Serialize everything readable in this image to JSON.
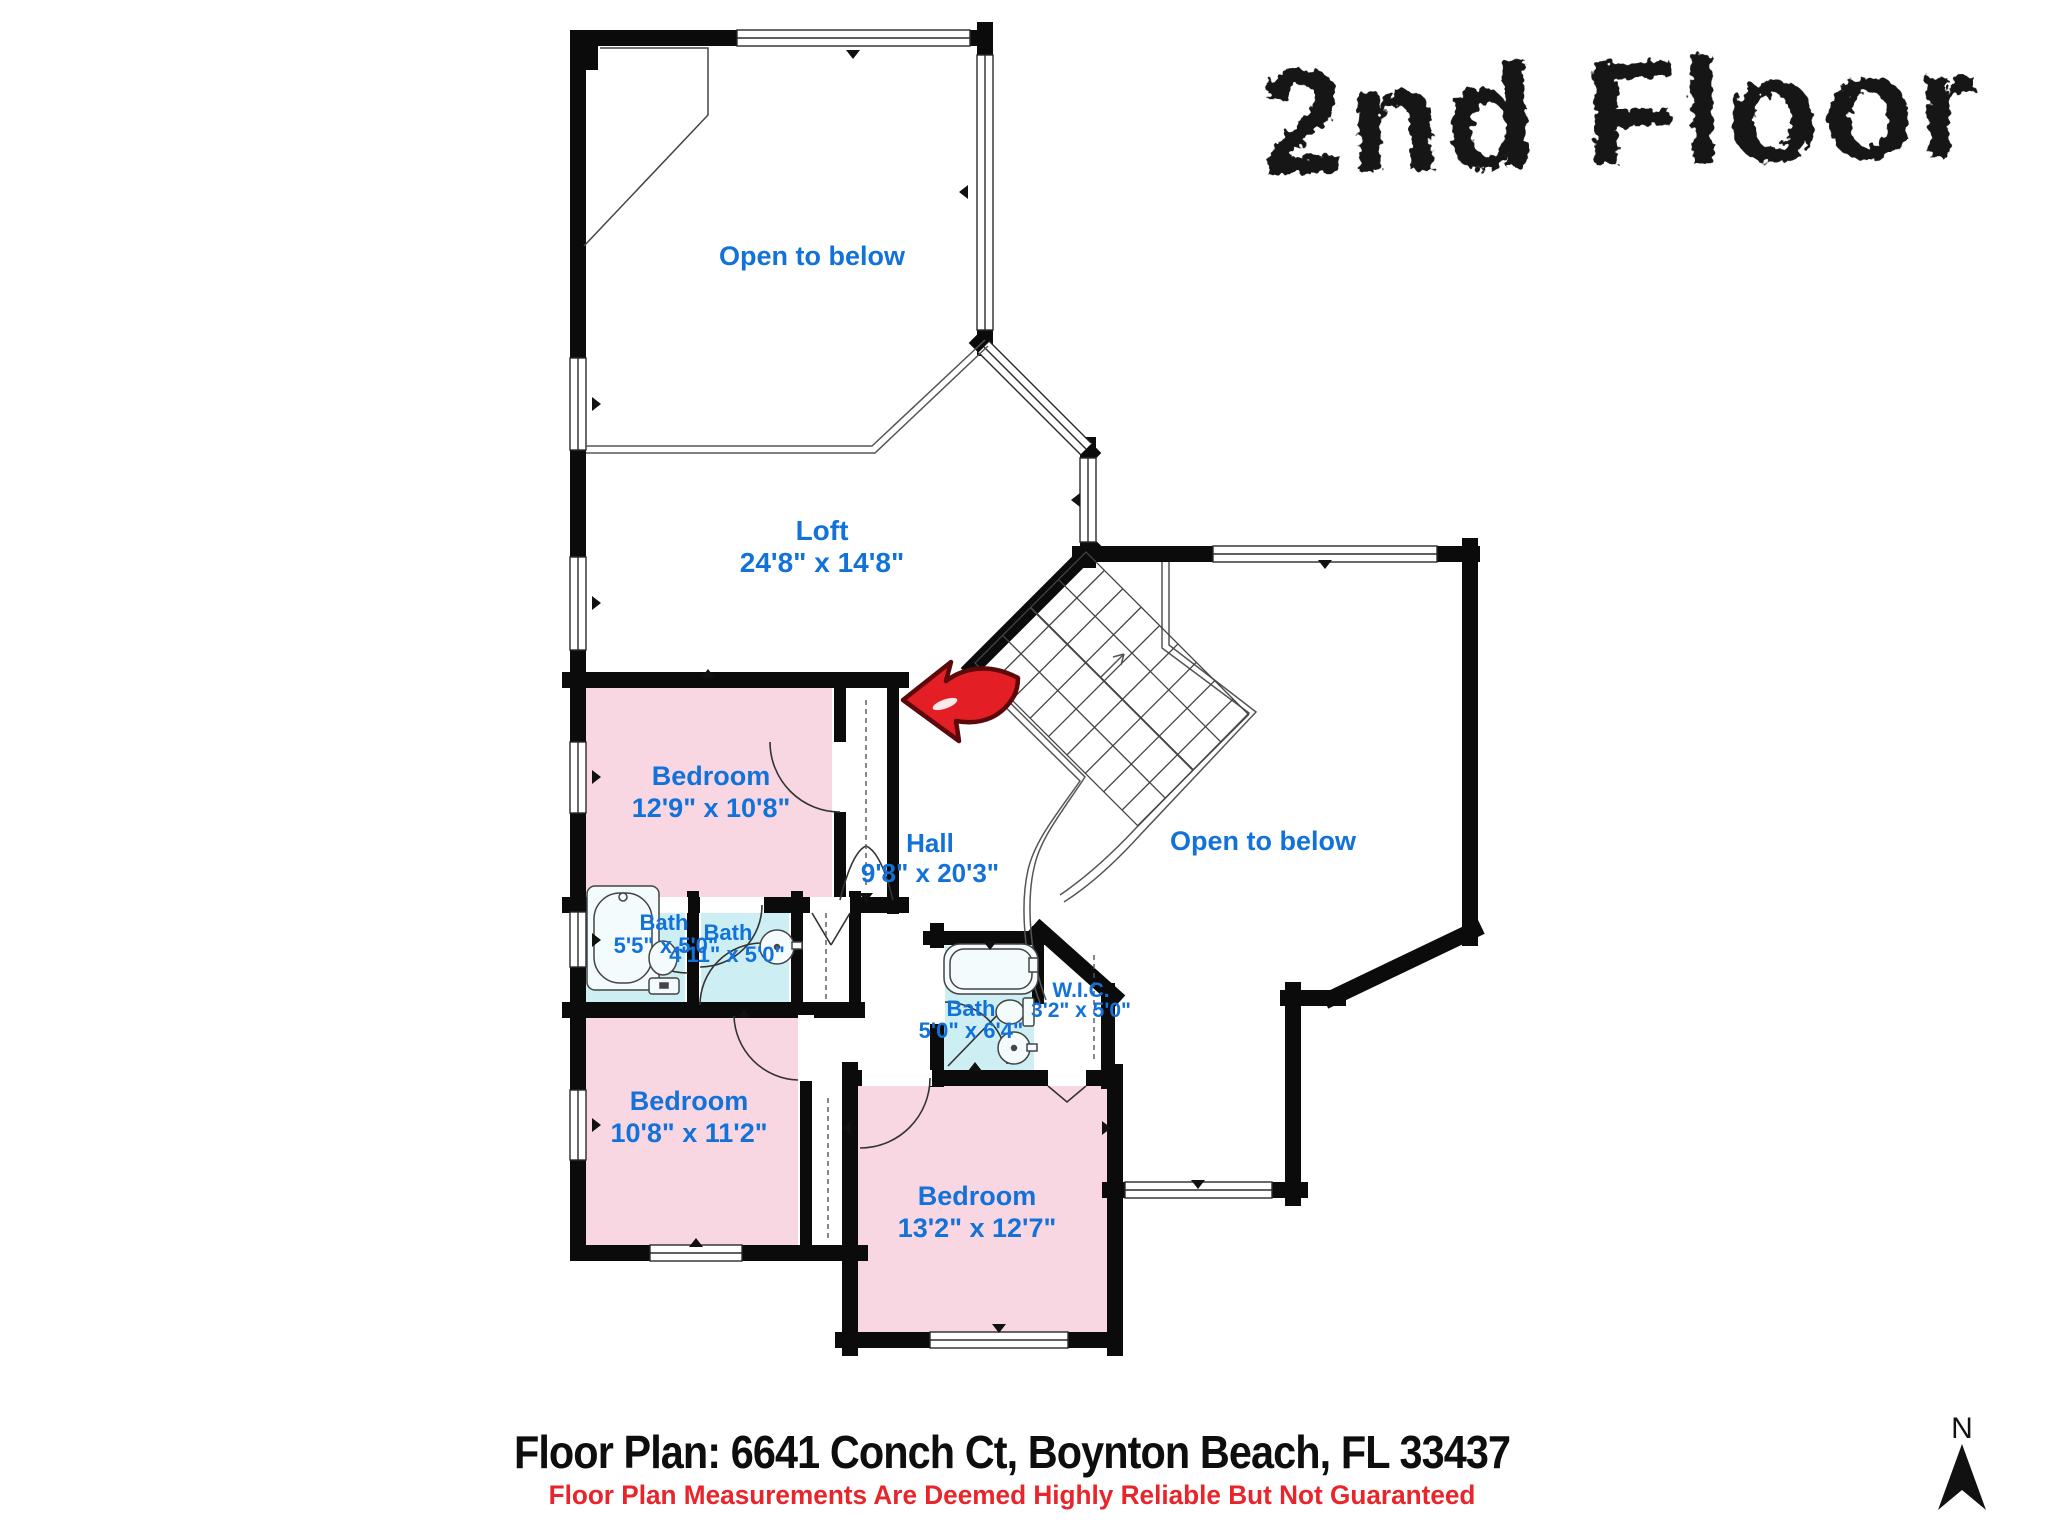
{
  "title": "2nd Floor",
  "rooms": {
    "open_below_top": {
      "name": "Open to below"
    },
    "loft": {
      "name": "Loft",
      "dims": "24'8\" x 14'8\""
    },
    "bedroom1": {
      "name": "Bedroom",
      "dims": "12'9\" x 10'8\""
    },
    "hall": {
      "name": "Hall",
      "dims": "9'8\" x 20'3\""
    },
    "open_below_right": {
      "name": "Open to below"
    },
    "bath1": {
      "name": "Bath",
      "dims": "5'5\" x 5'0\""
    },
    "bath2": {
      "name": "Bath",
      "dims": "4'11\" x 5'0\""
    },
    "bath3": {
      "name": "Bath",
      "dims": "5'0\" x 6'4\""
    },
    "wic": {
      "name": "W.I.C.",
      "dims": "3'2\" x 5'0\""
    },
    "bedroom2": {
      "name": "Bedroom",
      "dims": "10'8\" x 11'2\""
    },
    "bedroom3": {
      "name": "Bedroom",
      "dims": "13'2\" x 12'7\""
    }
  },
  "footer": {
    "address": "Floor Plan: 6641 Conch Ct, Boynton Beach, FL 33437",
    "disclaimer": "Floor Plan Measurements Are Deemed Highly Reliable But Not Guaranteed"
  },
  "compass": {
    "north_label": "N"
  },
  "colors": {
    "bedroom": "#f9d7e2",
    "bath": "#cdeef2",
    "label": "#1272d9",
    "wall": "#0b0b0b",
    "disclaimer_red": "#e8252a",
    "arrow_red": "#e31e24"
  }
}
